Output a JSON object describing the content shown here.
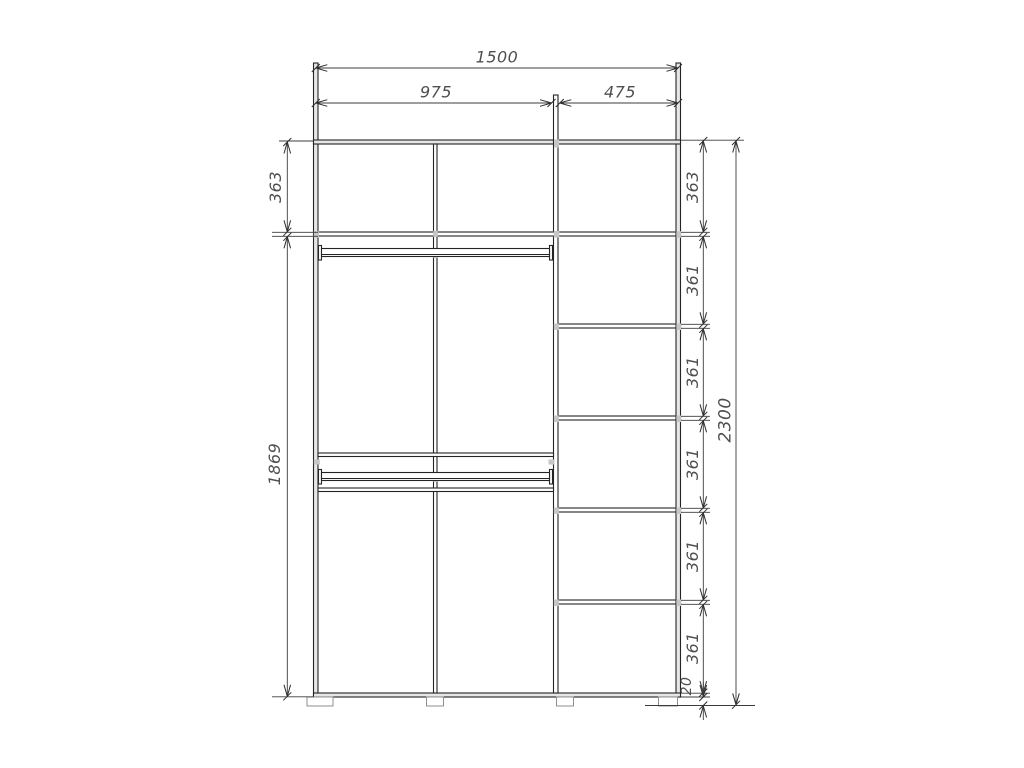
{
  "drawing": {
    "kind": "wardrobe-front-elevation-dimension-diagram",
    "labels": {
      "total_width": "1500",
      "left_width": "975",
      "right_width": "475",
      "total_height": "2300",
      "left_top_height": "363",
      "left_main_height": "1869",
      "right_top_height": "363",
      "right_row_heights": [
        "361",
        "361",
        "361",
        "361",
        "361"
      ],
      "plinth_height": "20"
    }
  }
}
